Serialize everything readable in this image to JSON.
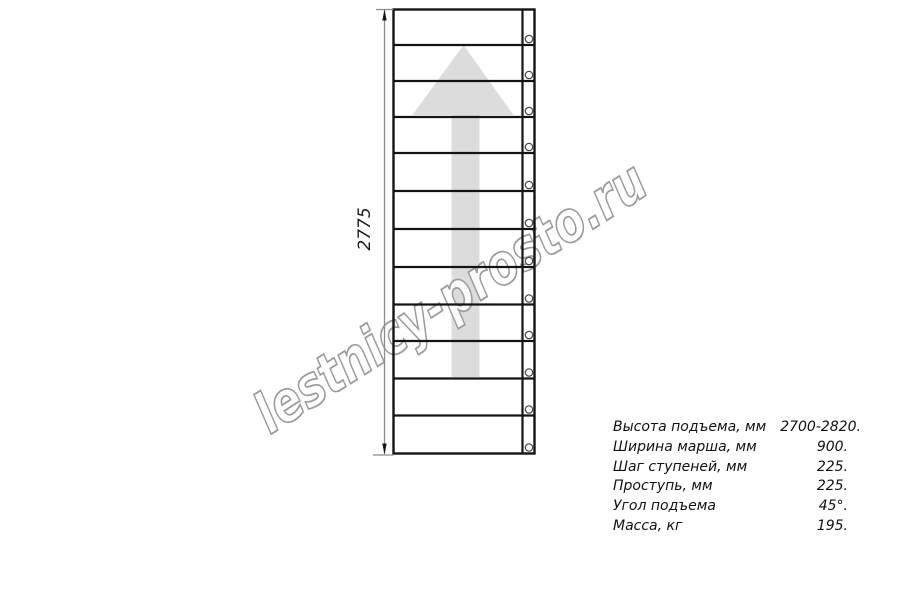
{
  "watermark": {
    "text": "lestnicy-prosto.ru",
    "outline_color": "#9c9c9c"
  },
  "drawing": {
    "description": "straight-staircase-top-view",
    "steps_count": 12,
    "bolt_count": 12,
    "arrow_color": "#dcdcdc",
    "line_color": "#141414",
    "dim_color": "#8c8c8c"
  },
  "dimension": {
    "height_label": "2775"
  },
  "specs": {
    "rows": [
      {
        "label": "Высота подъема, мм",
        "value": "2700-2820."
      },
      {
        "label": "Ширина марша, мм",
        "value": "900."
      },
      {
        "label": "Шаг ступеней, мм",
        "value": "225."
      },
      {
        "label": "Проступь, мм",
        "value": "225."
      },
      {
        "label": "Угол подъема",
        "value": "45°."
      },
      {
        "label": "Масса, кг",
        "value": "195."
      }
    ]
  }
}
